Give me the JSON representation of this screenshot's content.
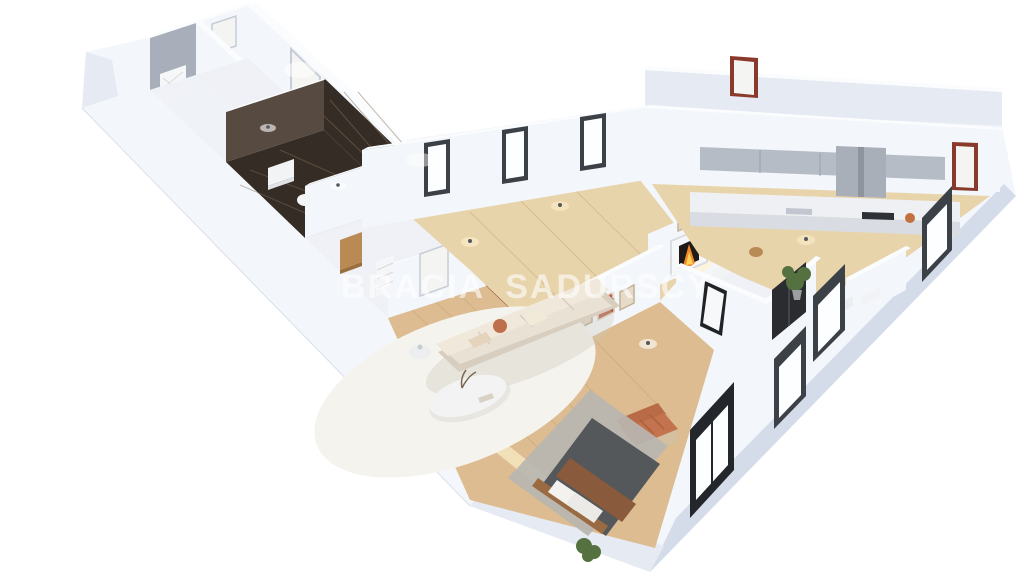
{
  "watermark": {
    "word1": "BRACIA",
    "word2": "SADURSCY",
    "logo": "double-triangle-mountains",
    "opacity": 0.6
  },
  "palette": {
    "bg": "#ffffff",
    "watermark": "#ffffff",
    "wallLit": "#f3f6fa",
    "wallMid": "#e6eaf3",
    "wallDark": "#d4dbe9",
    "wallTop": "#fbfcfe",
    "wallGrey": "#a9afba",
    "floorWhite": "#eff1f6",
    "floorWood": "#dcbc90",
    "floorWoodPale": "#e8d4ab",
    "bathDark": "#352c26",
    "bathLine": "#8a7358",
    "doorFrameRed": "#8a3a2b",
    "doorWhite": "#f4f4f3",
    "doorBlack": "#2a2c2f",
    "windowFrame": "#3c4147",
    "glass": "#fdfeff",
    "sofa": "#e9e2d4",
    "sofaShadow": "#d8cec0",
    "rugWhite": "#f5f3ee",
    "rugGrey": "#b8b6b1",
    "armchair": "#c3744e",
    "bedDuvet": "#54585b",
    "bedBrown": "#8a5a3c",
    "woodFurniture": "#b98a54",
    "plantGreen": "#55713f",
    "plankLine": "#c2a171",
    "fireOrange": "#f08a28",
    "fireYellow": "#ffd257",
    "glow": "#fff3d2"
  },
  "scene": {
    "type": "3d-floorplan-cutaway-render",
    "view": "isometric from above, white background",
    "rooms": [
      {
        "name": "far-room-grey",
        "furnishing": [
          "radiator-panel",
          "white-door"
        ]
      },
      {
        "name": "far-room-white",
        "furnishing": []
      },
      {
        "name": "bathroom-dark-marble",
        "furnishing": [
          "vanity",
          "toilet"
        ]
      },
      {
        "name": "utility-room",
        "furnishing": [
          "wood-cabinet",
          "wire-shelf"
        ]
      },
      {
        "name": "hallway-wood-floor",
        "furnishing": [
          "red-framed-doors"
        ]
      },
      {
        "name": "entry-hall-dining",
        "furnishing": [
          "fireplace",
          "wall-art",
          "dining-table",
          "chairs",
          "sideboard"
        ]
      },
      {
        "name": "living-room",
        "furnishing": [
          "beige-sofa",
          "white-rug",
          "organic-coffee-table",
          "side-table",
          "terracotta-armchair",
          "wall-art-frames"
        ]
      },
      {
        "name": "bedroom-zone",
        "furnishing": [
          "double-bed",
          "grey-rug",
          "floor-plant",
          "lit-step"
        ]
      },
      {
        "name": "kitchen",
        "furnishing": [
          "counter-run",
          "sink",
          "dark-cooktop",
          "upper-cabinets",
          "tall-cabinet",
          "stool",
          "orange-bowl"
        ]
      },
      {
        "name": "closet-room",
        "furnishing": [
          "leaning-mirror",
          "black-wardrobe-door"
        ]
      },
      {
        "name": "small-bathroom",
        "furnishing": [
          "toilet",
          "washbasin",
          "tall-plant"
        ]
      }
    ],
    "openings": {
      "red_framed_doors": 5,
      "white_doors": 4,
      "black_wardrobe_doors": 1,
      "north_windows": 3,
      "southeast_windows": 3,
      "balcony_doors": 1
    },
    "lighting": [
      "ceiling-spots",
      "fireplace-glow",
      "step-strip-light"
    ]
  }
}
